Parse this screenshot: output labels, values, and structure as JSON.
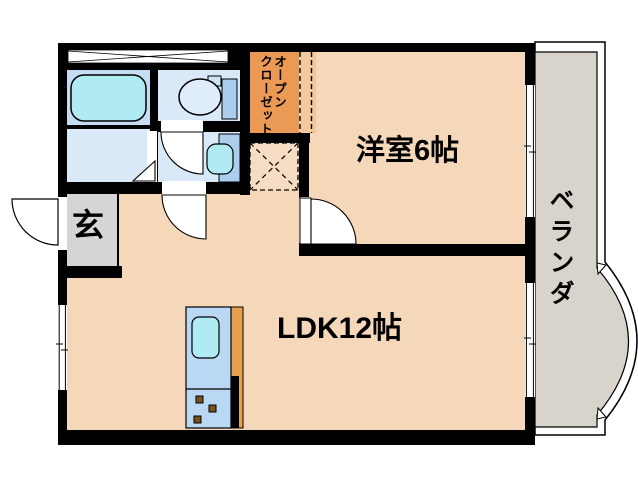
{
  "rooms": {
    "entrance": {
      "label": "玄"
    },
    "western_room": {
      "label": "洋室6帖"
    },
    "ldk": {
      "label": "LDK12帖"
    },
    "veranda": {
      "label": "ベランダ"
    },
    "open_closet": {
      "label": "オープンクローゼット",
      "columns": [
        "オープン",
        "クローゼット"
      ]
    }
  },
  "palette": {
    "wall": "#000000",
    "floor": "#f5d8ba",
    "wet_room": "#d9e9f8",
    "bath_room": "#c6dcf3",
    "fixture_cyan": "#b0eaf3",
    "fixture_blue": "#abceef",
    "toilet_bowl": "#dfecfa",
    "kitchen_blue": "#bad7f3",
    "burner_brown": "#7a4f1a",
    "closet_orange": "#eb9a55",
    "closet_light": "#f4c79c",
    "counter_orange": "#e6a04c",
    "entrance_gray": "#d5d5d5",
    "veranda_gray": "#d8d3cb",
    "hatch_bg": "#f5dcc2"
  }
}
